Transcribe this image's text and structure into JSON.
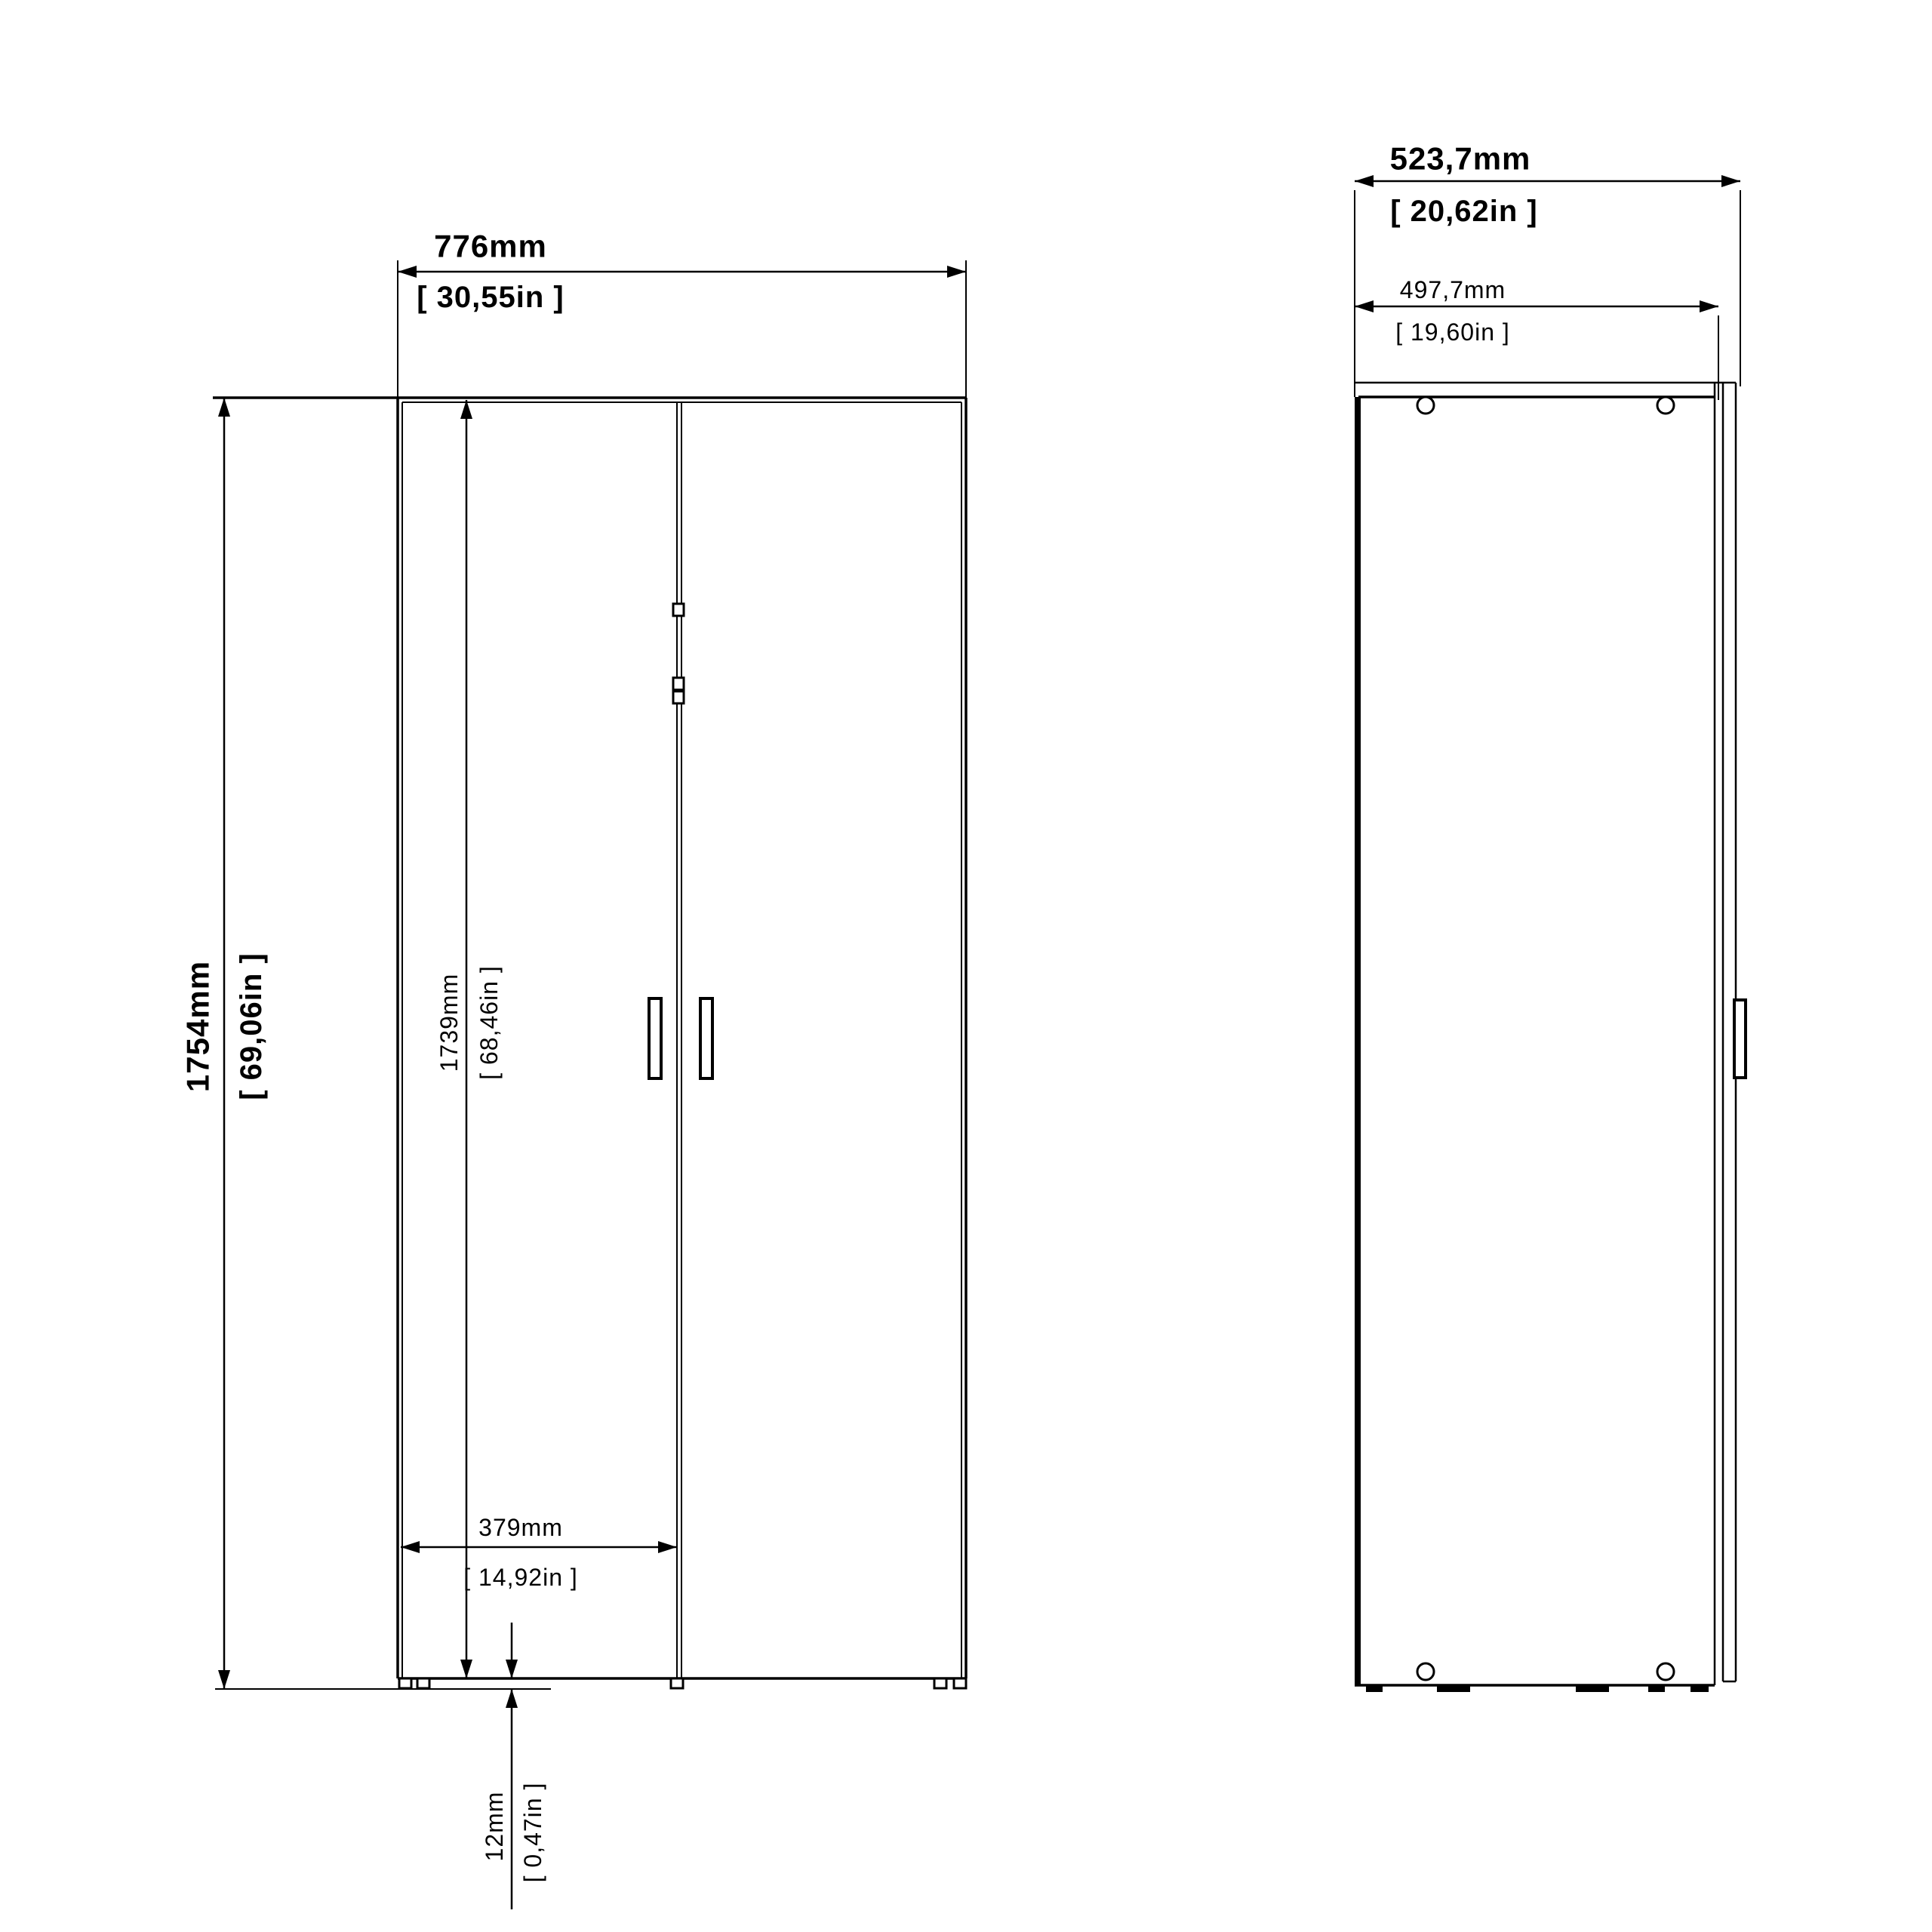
{
  "page": {
    "background": "#ffffff",
    "line_color": "#000000"
  },
  "front_view": {
    "name": "wardrobe-front-elevation",
    "dims": {
      "width_mm": "776mm",
      "width_in": "[ 30,55in ]",
      "height_mm": "1754mm",
      "height_in": "[ 69,06in ]",
      "door_height_mm": "1739mm",
      "door_height_in": "[ 68,46in ]",
      "door_width_mm": "379mm",
      "door_width_in": "[ 14,92in ]",
      "base_height_mm": "12mm",
      "base_height_in": "[ 0,47in ]"
    }
  },
  "side_view": {
    "name": "wardrobe-side-elevation",
    "dims": {
      "total_depth_mm": "523,7mm",
      "total_depth_in": "[ 20,62in ]",
      "body_depth_mm": "497,7mm",
      "body_depth_in": "[ 19,60in ]"
    }
  }
}
